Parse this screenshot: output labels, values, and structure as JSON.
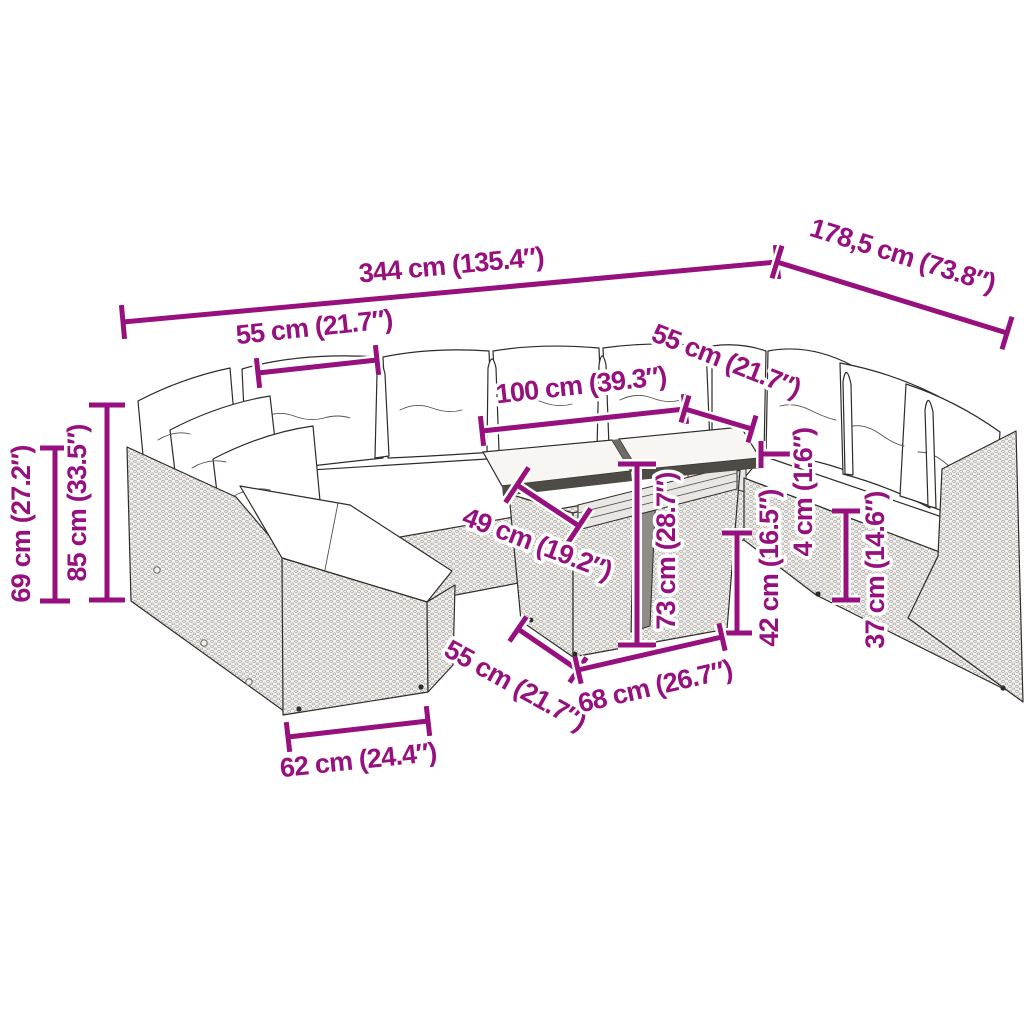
{
  "diagram": {
    "type": "product-dimension-diagram",
    "subject": "rattan garden lounge sofa set with cushions and two-top glass table",
    "background": "#ffffff"
  },
  "colors": {
    "dimension": "#96107E",
    "outline": "#2e2c2a",
    "cushion": "#ffffff",
    "wicker": "#f1f0ee",
    "wicker_dot": "#a39e97",
    "table_edge": "#4e4a46"
  },
  "dimensions": [
    {
      "id": "overall-length",
      "label": "344 cm (135.4″)",
      "type": "linear",
      "x1": 123,
      "y1": 322,
      "x2": 777,
      "y2": 262,
      "tick": 34,
      "label_x": 452,
      "label_y": 274,
      "label_rotate": -5.3
    },
    {
      "id": "overall-depth",
      "label": "178,5 cm (73.8″)",
      "type": "linear",
      "x1": 777,
      "y1": 262,
      "x2": 1007,
      "y2": 333,
      "tick": 34,
      "label_x": 900,
      "label_y": 264,
      "label_rotate": 17.3
    },
    {
      "id": "seat-width-back",
      "label": "55 cm (21.7″)",
      "type": "linear",
      "x1": 258,
      "y1": 373,
      "x2": 377,
      "y2": 360,
      "tick": 30,
      "label_x": 315,
      "label_y": 336,
      "label_rotate": -6
    },
    {
      "id": "table-top-length",
      "label": "100 cm (39.3″)",
      "type": "linear",
      "x1": 482,
      "y1": 431,
      "x2": 685,
      "y2": 409,
      "tick": 30,
      "label_x": 582,
      "label_y": 394,
      "label_rotate": -6.3
    },
    {
      "id": "seat-width-right",
      "label": "55 cm (21.7″)",
      "type": "linear",
      "x1": 685,
      "y1": 409,
      "x2": 752,
      "y2": 429,
      "tick": 28,
      "label_x": 723,
      "label_y": 369,
      "label_rotate": 21.5
    },
    {
      "id": "cushion-thickness",
      "label": "4 cm (1.6″)",
      "type": "bracket",
      "segments": [
        [
          761,
          441,
          761,
          468
        ],
        [
          797,
          441,
          797,
          468
        ],
        [
          761,
          454,
          797,
          454
        ]
      ],
      "label_x": 812,
      "label_y": 492,
      "label_rotate": -90
    },
    {
      "id": "seat-height-right",
      "label": "42 cm (16.5″)",
      "type": "linear",
      "x1": 737,
      "y1": 533,
      "x2": 737,
      "y2": 633,
      "tick": 30,
      "label_x": 778,
      "label_y": 568,
      "label_rotate": -90
    },
    {
      "id": "base-height-right",
      "label": "37 cm (14.6″)",
      "type": "linear",
      "x1": 846,
      "y1": 511,
      "x2": 846,
      "y2": 600,
      "tick": 28,
      "label_x": 884,
      "label_y": 570,
      "label_rotate": -90
    },
    {
      "id": "table-height",
      "label": "73 cm (28.7″)",
      "type": "linear",
      "x1": 637,
      "y1": 464,
      "x2": 637,
      "y2": 645,
      "tick": 38,
      "label_x": 675,
      "label_y": 551,
      "label_rotate": -90
    },
    {
      "id": "table-top-depth",
      "label": "49 cm (19.2″)",
      "type": "linear",
      "x1": 517,
      "y1": 485,
      "x2": 579,
      "y2": 526,
      "tick": 42,
      "label_x": 534,
      "label_y": 552,
      "label_rotate": 21
    },
    {
      "id": "table-base-depth",
      "label": "55 cm (21.7″)",
      "type": "linear",
      "x1": 518,
      "y1": 629,
      "x2": 578,
      "y2": 670,
      "tick": 30,
      "label_x": 511,
      "label_y": 693,
      "label_rotate": 29
    },
    {
      "id": "table-base-width",
      "label": "68 cm (26.7″)",
      "type": "linear",
      "x1": 578,
      "y1": 670,
      "x2": 722,
      "y2": 637,
      "tick": 28,
      "label_x": 657,
      "label_y": 695,
      "label_rotate": -13
    },
    {
      "id": "seat-depth-front",
      "label": "62 cm (24.4″)",
      "type": "linear",
      "x1": 288,
      "y1": 737,
      "x2": 428,
      "y2": 721,
      "tick": 30,
      "label_x": 359,
      "label_y": 769,
      "label_rotate": -6
    },
    {
      "id": "total-height",
      "label": "85 cm (33.5″)",
      "type": "linear",
      "x1": 107,
      "y1": 405,
      "x2": 107,
      "y2": 600,
      "tick": 36,
      "label_x": 86,
      "label_y": 503,
      "label_rotate": -90
    },
    {
      "id": "arm-height",
      "label": "69 cm (27.2″)",
      "type": "linear",
      "x1": 55,
      "y1": 448,
      "x2": 55,
      "y2": 601,
      "tick": 30,
      "label_x": 30,
      "label_y": 524,
      "label_rotate": -90
    }
  ]
}
